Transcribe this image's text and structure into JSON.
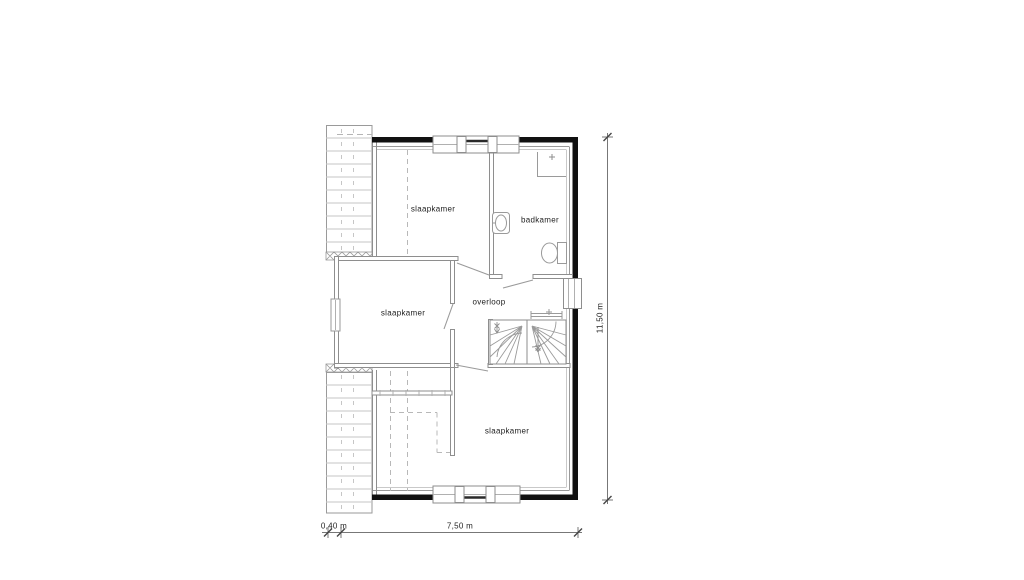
{
  "floor_plan": {
    "room_labels": [
      {
        "id": "slaapkamer_top",
        "label": "slaapkamer"
      },
      {
        "id": "badkamer",
        "label": "badkamer"
      },
      {
        "id": "slaapkamer_middle",
        "label": "slaapkamer"
      },
      {
        "id": "overloop",
        "label": "overloop"
      },
      {
        "id": "slaapkamer_bottom",
        "label": "slaapkamer"
      }
    ],
    "dimensions": {
      "bottom_left": "0,40 m",
      "bottom_main": "7,50 m",
      "right": "11,50 m"
    },
    "fixtures": [
      "shower",
      "washbasin",
      "toilet",
      "winder-stairs"
    ],
    "colors": {
      "wall": "#111111",
      "wall_line": "#8e8e8e",
      "light_line": "#c6c6c6",
      "text": "#222222",
      "background": "#ffffff"
    }
  }
}
